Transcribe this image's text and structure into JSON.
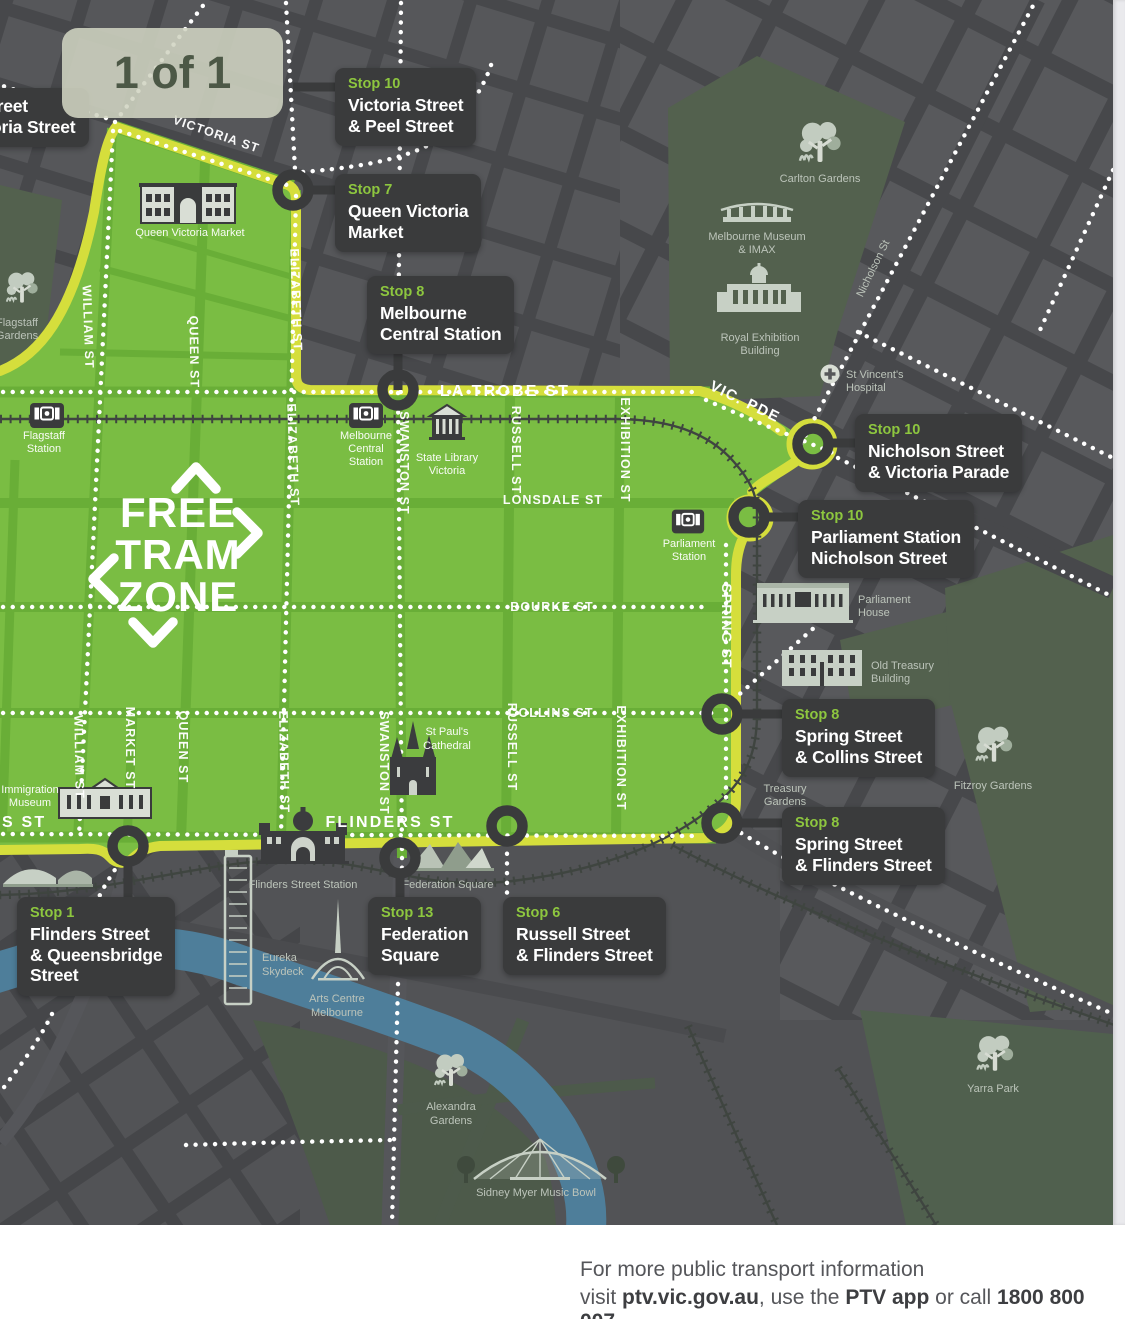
{
  "page_indicator": "1 of 1",
  "colors": {
    "zone_green": "#7abd43",
    "zone_border_yellow": "#d5de3c",
    "stop_badge_green": "#8dc63f",
    "stop_box_dark": "#3a3b3c",
    "river_blue": "#4e7e9a",
    "park_green": "#53614e"
  },
  "zone_mark": {
    "free": "FREE",
    "tram": "TRAM",
    "zone": "ZONE"
  },
  "stops": [
    {
      "badge": "",
      "lines": [
        "treet",
        "oria Street"
      ]
    },
    {
      "badge": "Stop 10",
      "lines": [
        "Victoria Street",
        "& Peel Street"
      ]
    },
    {
      "badge": "Stop 7",
      "lines": [
        "Queen Victoria",
        "Market"
      ]
    },
    {
      "badge": "Stop 8",
      "lines": [
        "Melbourne",
        "Central Station"
      ]
    },
    {
      "badge": "Stop 10",
      "lines": [
        "Nicholson Street",
        "& Victoria Parade"
      ]
    },
    {
      "badge": "Stop 10",
      "lines": [
        "Parliament Station",
        "Nicholson Street"
      ]
    },
    {
      "badge": "Stop 8",
      "lines": [
        "Spring Street",
        "& Collins Street"
      ]
    },
    {
      "badge": "Stop 8",
      "lines": [
        "Spring Street",
        "& Flinders Street"
      ]
    },
    {
      "badge": "Stop 1",
      "lines": [
        "Flinders Street",
        "& Queensbridge",
        "Street"
      ]
    },
    {
      "badge": "Stop 13",
      "lines": [
        "Federation",
        "Square"
      ]
    },
    {
      "badge": "Stop 6",
      "lines": [
        "Russell Street",
        "& Flinders Street"
      ]
    }
  ],
  "streets": {
    "victoria": "VICTORIA ST",
    "william": "WILLIAM ST",
    "queen": "QUEEN ST",
    "market": "MARKET ST",
    "elizabeth": "ELIZABETH ST",
    "swanston": "SWANSTON ST",
    "russell": "RUSSELL ST",
    "exhibition": "EXHIBITION ST",
    "spring": "SPRING ST",
    "latrobe": "LA TROBE ST",
    "lonsdale": "LONSDALE ST",
    "bourke": "BOURKE ST",
    "collins": "COLLINS ST",
    "flinders": "FLINDERS ST",
    "flinders_partial": "S ST",
    "vicpde": "VIC. PDE",
    "nicholson": "Nicholson St"
  },
  "landmarks": {
    "flagstaff_gardens": {
      "lines": [
        "Flagstaff",
        "Gardens"
      ]
    },
    "flagstaff_station": {
      "lines": [
        "Flagstaff",
        "Station"
      ]
    },
    "qvm": {
      "lines": [
        "Queen Victoria Market"
      ]
    },
    "melbourne_central": {
      "lines": [
        "Melbourne",
        "Central",
        "Station"
      ]
    },
    "state_library": {
      "lines": [
        "State Library",
        "Victoria"
      ]
    },
    "parliament_station": {
      "lines": [
        "Parliament",
        "Station"
      ]
    },
    "parliament_house": {
      "lines": [
        "Parliament",
        "House"
      ]
    },
    "old_treasury": {
      "lines": [
        "Old Treasury",
        "Building"
      ]
    },
    "st_pauls": {
      "lines": [
        "St Paul's",
        "Cathedral"
      ]
    },
    "immigration_museum": {
      "lines": [
        "Immigration",
        "Museum"
      ]
    },
    "flinders_station": {
      "lines": [
        "Flinders Street Station"
      ]
    },
    "federation_square": {
      "lines": [
        "Federation Square"
      ]
    },
    "eureka": {
      "lines": [
        "Eureka",
        "Skydeck"
      ]
    },
    "arts_centre": {
      "lines": [
        "Arts Centre",
        "Melbourne"
      ]
    },
    "alexandra_gardens": {
      "lines": [
        "Alexandra",
        "Gardens"
      ]
    },
    "music_bowl": {
      "lines": [
        "Sidney Myer Music Bowl"
      ]
    },
    "carlton_gardens": {
      "lines": [
        "Carlton Gardens"
      ]
    },
    "melbourne_museum": {
      "lines": [
        "Melbourne Museum",
        "& IMAX"
      ]
    },
    "royal_exhibition": {
      "lines": [
        "Royal Exhibition",
        "Building"
      ]
    },
    "st_vincents": {
      "lines": [
        "St Vincent's",
        "Hospital"
      ]
    },
    "treasury_gardens": {
      "lines": [
        "Treasury",
        "Gardens"
      ]
    },
    "fitzroy_gardens": {
      "lines": [
        "Fitzroy Gardens"
      ]
    },
    "yarra_park": {
      "lines": [
        "Yarra Park"
      ]
    }
  },
  "footer": {
    "line1": "For more public transport information",
    "visit": "visit ",
    "url": "ptv.vic.gov.au",
    "use": ", use the ",
    "app": "PTV app",
    "call": " or call ",
    "phone": "1800 800 007",
    "dot": "."
  }
}
